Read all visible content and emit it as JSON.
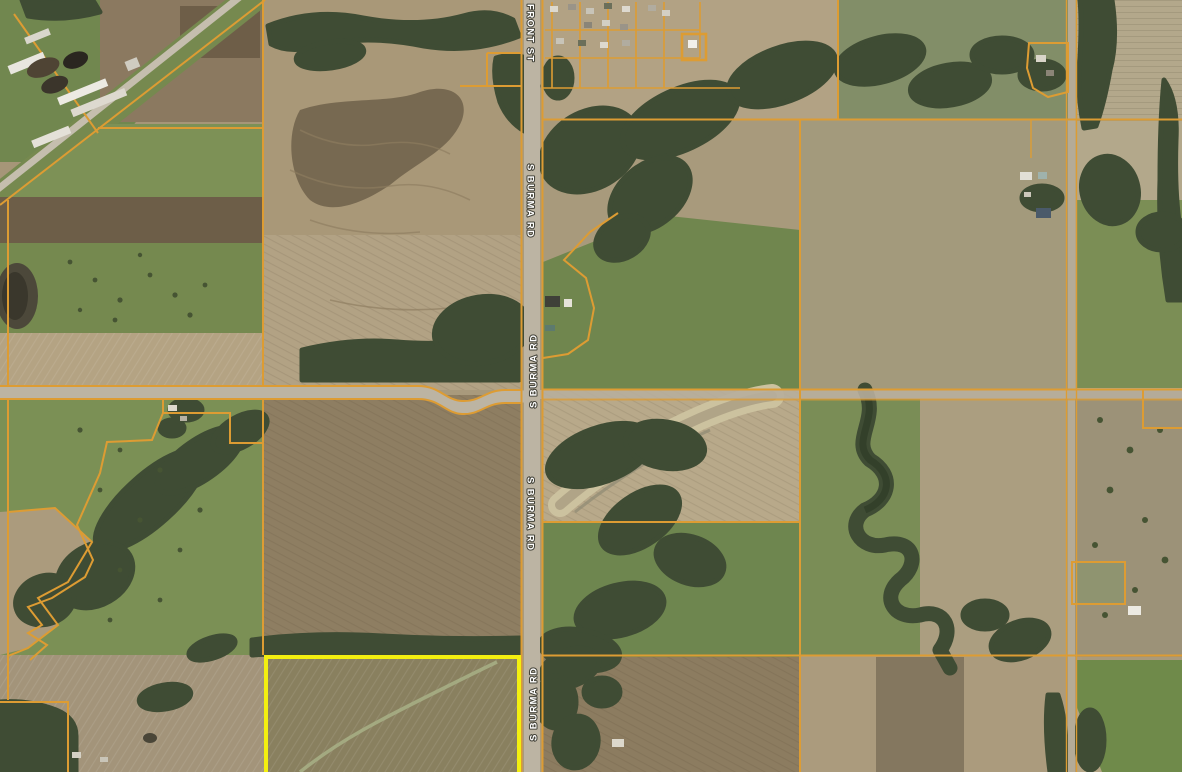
{
  "map": {
    "view_type": "aerial-parcel-map",
    "road_labels": [
      {
        "id": "front-st",
        "text": "FRONT ST",
        "orientation": "vertical",
        "reads": "down"
      },
      {
        "id": "s-burma-rd-1",
        "text": "S BURMA RD",
        "orientation": "vertical",
        "reads": "down"
      },
      {
        "id": "s-burma-rd-2",
        "text": "S BURMA RD",
        "orientation": "vertical",
        "reads": "up"
      },
      {
        "id": "s-burma-rd-3",
        "text": "S BURMA RD",
        "orientation": "vertical",
        "reads": "down"
      },
      {
        "id": "s-burma-rd-4",
        "text": "S BURMA RD",
        "orientation": "vertical",
        "reads": "up"
      }
    ],
    "colors": {
      "parcel_line": "#dd9c33",
      "highlight_parcel": "#f3ef10",
      "label_fill": "#ffffff",
      "label_outline": "#45443a",
      "road_surface": "#bcb4a3"
    }
  }
}
